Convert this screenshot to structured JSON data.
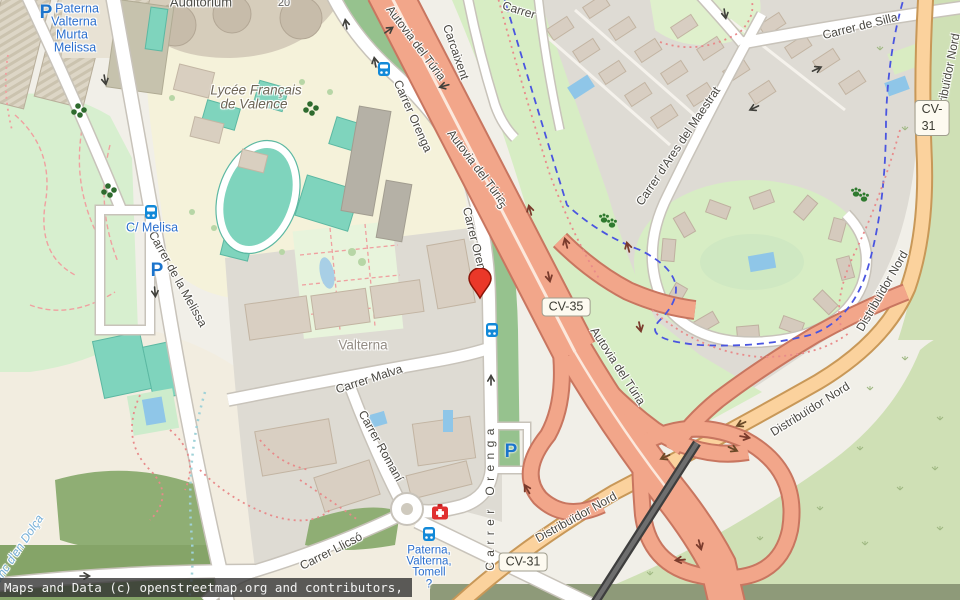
{
  "map": {
    "attribution": "Maps and Data (c) openstreetmap.org and contributors, ODbL"
  },
  "road_badges": {
    "cv35": "CV-35",
    "cv31_ne": "CV-31",
    "cv31_s": "CV-31",
    "exit_5": "5"
  },
  "street_labels": {
    "autovia_n": "Autovia del Túria",
    "autovia_mid": "Autovia del Túria",
    "autovia_s": "Autovia del Túria",
    "distribuidor_ne": "Distribuïdor Nord",
    "distribuidor_e": "Distribuïdor Nord",
    "distribuidor_se": "Distribuïdor Nord",
    "distribuidor_s": "Distribuïdor Nord",
    "orenga_n": "Carrer Orenga",
    "orenga_mid": "Carrer Orenga",
    "orenga_s": "Carrer Orenga",
    "melissa": "Carrer de la Melissa",
    "malva": "Carrer Malva",
    "romani": "Carrer Romaní",
    "llicso": "Carrer Llicsó",
    "silla": "Carrer de Silla",
    "ares": "Carrer d'Ares del Maestrat",
    "carcaixent": "Carcaixent",
    "carrer_partial": "Carrer"
  },
  "place_labels": {
    "auditorium": "Auditorium",
    "lycee_line1": "Lycée Français",
    "lycee_line2": "de Valence",
    "valterna": "Valterna",
    "house_20": "20",
    "stream": "Barranc d'en Dolça"
  },
  "transit_labels": {
    "stop_nw": [
      "Paterna",
      "Valterna",
      "Murta",
      "Melissa"
    ],
    "stop_melisa": "C/ Melisa",
    "stop_s": [
      "Paterna,",
      "Valterna,",
      "Tomell",
      "?"
    ]
  },
  "icons": {
    "parking_glyph": "P"
  }
}
